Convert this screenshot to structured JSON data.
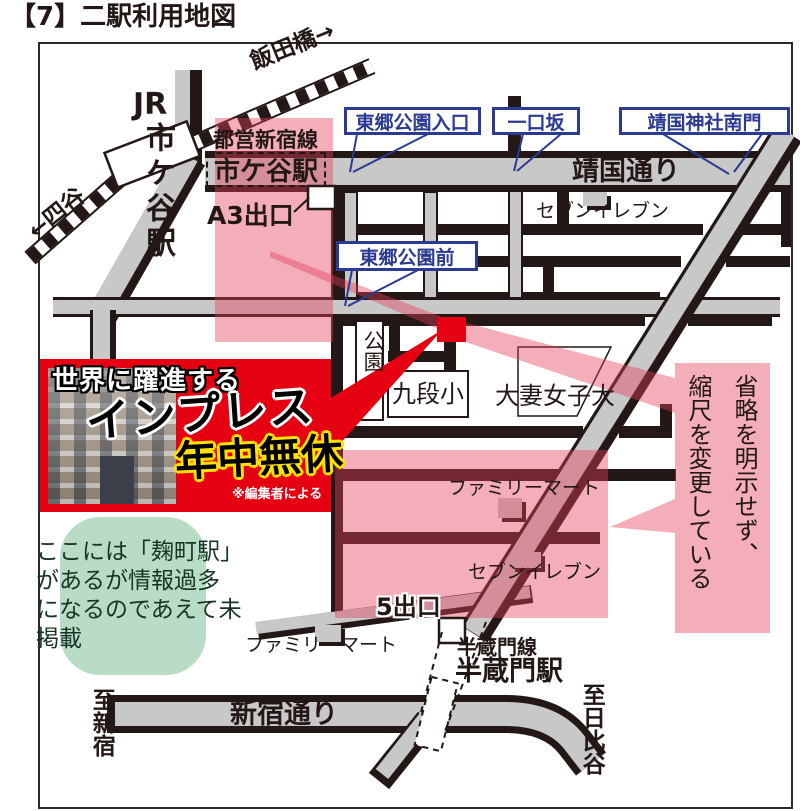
{
  "page": {
    "title": "【7】二駅利用地図"
  },
  "map": {
    "railway": {
      "iidabashi": "飯田橋→",
      "yotsuya": "←四谷",
      "jr_prefix": "JR",
      "jr_station": "市ケ谷駅"
    },
    "toei": {
      "line": "都営新宿線",
      "station": "市ケ谷駅",
      "exit": "A3出口"
    },
    "callouts": {
      "togo_entrance": "東郷公園入口",
      "hitokuchizaka": "一口坂",
      "yasukuni_gate": "靖国神社南門",
      "togo_front": "東郷公園前"
    },
    "streets": {
      "yasukuni": "靖国通り",
      "shinjuku": "新宿通り"
    },
    "places": {
      "seven_top": "セブンイレブン",
      "park": "公園",
      "kudan_elementary": "九段小",
      "otsuma_univ": "大妻女子大",
      "family_mart_mid": "ファミリーマート",
      "seven_bottom": "セブンイレブン",
      "family_mart_south": "ファミリーマート"
    },
    "hanzomon": {
      "exit5": "5出口",
      "line": "半蔵門線",
      "station": "半蔵門駅"
    },
    "directions": {
      "to_shinjuku": "至新宿",
      "to_hibiya": "至日比谷"
    }
  },
  "ad": {
    "tagline": "世界に躍進する",
    "brand": "インプレス",
    "always_open": "年中無休",
    "note": "※編集者による"
  },
  "notes": {
    "bubble": "ここには「麹町駅」\nがあるが情報過多\nになるのであえて未\n掲載",
    "annotation": "省略を明示せず、\n縮尺を変更している"
  },
  "colors": {
    "print_black": "#231815",
    "road_gray": "#c8c8c9",
    "highlight_pink": "#e33d58",
    "ad_red": "#e50012",
    "callout_blue": "#2b3a92",
    "bubble_green": "#b9dcc6",
    "accent_yellow": "#ffe100"
  }
}
